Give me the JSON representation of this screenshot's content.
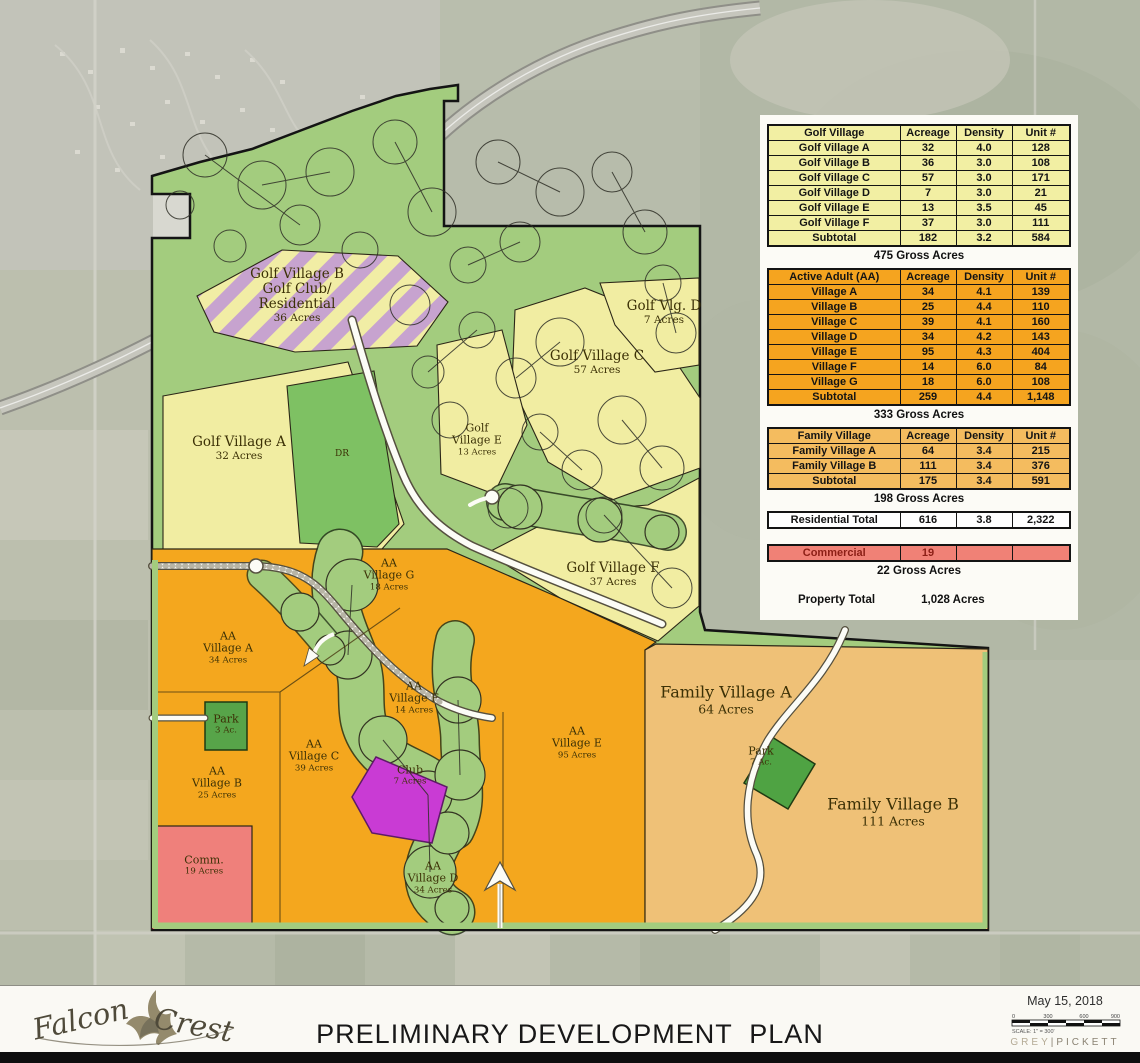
{
  "colors": {
    "golf_green": "#a3cc7e",
    "village_yellow": "#f1eda2",
    "active_adult_orange": "#f4a71e",
    "family_tan": "#efc177",
    "commercial_pink": "#ef807b",
    "club_magenta": "#c93bd4",
    "park_green": "#4fa343",
    "stripe_lavender": "#c7a3cf",
    "table_yellow": "#f2efa3",
    "table_orange": "#f5a41f",
    "table_tan": "#f4bc5f",
    "table_pink": "#f08176"
  },
  "map": {
    "labels": [
      {
        "id": "golf-village-b",
        "size": "md",
        "x": 297,
        "y": 296,
        "lines": [
          "Golf Village B",
          "Golf Club/",
          "Residential"
        ],
        "sub": "36 Acres"
      },
      {
        "id": "golf-vlg-d",
        "size": "md",
        "x": 664,
        "y": 313,
        "lines": [
          "Golf Vlg. D"
        ],
        "sub": "7 Acres"
      },
      {
        "id": "golf-village-c",
        "size": "md",
        "x": 597,
        "y": 363,
        "lines": [
          "Golf Village C"
        ],
        "sub": "57 Acres"
      },
      {
        "id": "golf-village-a",
        "size": "md",
        "x": 239,
        "y": 449,
        "lines": [
          "Golf Village A"
        ],
        "sub": "32 Acres"
      },
      {
        "id": "driving-range",
        "size": "xs",
        "x": 342,
        "y": 454,
        "lines": [
          "DR"
        ],
        "sub": ""
      },
      {
        "id": "golf-village-e",
        "size": "sm",
        "x": 477,
        "y": 440,
        "lines": [
          "Golf",
          "Village E"
        ],
        "sub": "13 Acres"
      },
      {
        "id": "golf-village-f",
        "size": "md",
        "x": 613,
        "y": 575,
        "lines": [
          "Golf Village F"
        ],
        "sub": "37 Acres"
      },
      {
        "id": "aa-village-g",
        "size": "sm",
        "x": 389,
        "y": 575,
        "lines": [
          "AA",
          "Village G"
        ],
        "sub": "18 Acres"
      },
      {
        "id": "aa-village-a",
        "size": "sm",
        "x": 228,
        "y": 648,
        "lines": [
          "AA",
          "Village A"
        ],
        "sub": "34 Acres"
      },
      {
        "id": "aa-village-f",
        "size": "sm",
        "x": 414,
        "y": 698,
        "lines": [
          "AA",
          "Village F"
        ],
        "sub": "14 Acres"
      },
      {
        "id": "park-3ac",
        "size": "sm",
        "x": 226,
        "y": 725,
        "lines": [
          "Park"
        ],
        "sub": "3 Ac."
      },
      {
        "id": "aa-village-c",
        "size": "sm",
        "x": 314,
        "y": 756,
        "lines": [
          "AA",
          "Village C"
        ],
        "sub": "39 Acres"
      },
      {
        "id": "aa-village-b",
        "size": "sm",
        "x": 217,
        "y": 783,
        "lines": [
          "AA",
          "Village B"
        ],
        "sub": "25 Acres"
      },
      {
        "id": "club",
        "size": "sm",
        "x": 410,
        "y": 776,
        "lines": [
          "Club"
        ],
        "sub": "7 Acres"
      },
      {
        "id": "aa-village-e",
        "size": "sm",
        "x": 577,
        "y": 743,
        "lines": [
          "AA",
          "Village E"
        ],
        "sub": "95 Acres"
      },
      {
        "id": "aa-village-d",
        "size": "sm",
        "x": 433,
        "y": 878,
        "lines": [
          "AA",
          "Village D"
        ],
        "sub": "34 Acres"
      },
      {
        "id": "commercial",
        "size": "sm",
        "x": 204,
        "y": 866,
        "lines": [
          "Comm."
        ],
        "sub": "19 Acres"
      },
      {
        "id": "family-village-a",
        "size": "lg",
        "x": 726,
        "y": 700,
        "lines": [
          "Family Village A"
        ],
        "sub": "64 Acres"
      },
      {
        "id": "park-7ac",
        "size": "sm",
        "x": 761,
        "y": 757,
        "lines": [
          "Park"
        ],
        "sub": "7 Ac."
      },
      {
        "id": "family-village-b",
        "size": "lg",
        "x": 893,
        "y": 812,
        "lines": [
          "Family Village B"
        ],
        "sub": "111 Acres"
      }
    ]
  },
  "summary": {
    "columns": [
      "Acreage",
      "Density",
      "Unit #"
    ],
    "sections": [
      {
        "kind": "table",
        "name": "golf-village-table",
        "theme": "golf",
        "title": "Golf Village",
        "rows": [
          [
            "Golf Village A",
            "32",
            "4.0",
            "128"
          ],
          [
            "Golf Village B",
            "36",
            "3.0",
            "108"
          ],
          [
            "Golf Village C",
            "57",
            "3.0",
            "171"
          ],
          [
            "Golf Village D",
            "7",
            "3.0",
            "21"
          ],
          [
            "Golf Village E",
            "13",
            "3.5",
            "45"
          ],
          [
            "Golf Village F",
            "37",
            "3.0",
            "111"
          ]
        ],
        "subtotal": [
          "Subtotal",
          "182",
          "3.2",
          "584"
        ],
        "gross": "475 Gross Acres"
      },
      {
        "kind": "table",
        "name": "active-adult-table",
        "theme": "aa",
        "title": "Active Adult (AA)",
        "rows": [
          [
            "Village A",
            "34",
            "4.1",
            "139"
          ],
          [
            "Village B",
            "25",
            "4.4",
            "110"
          ],
          [
            "Village C",
            "39",
            "4.1",
            "160"
          ],
          [
            "Village D",
            "34",
            "4.2",
            "143"
          ],
          [
            "Village E",
            "95",
            "4.3",
            "404"
          ],
          [
            "Village F",
            "14",
            "6.0",
            "84"
          ],
          [
            "Village G",
            "18",
            "6.0",
            "108"
          ]
        ],
        "subtotal": [
          "Subtotal",
          "259",
          "4.4",
          "1,148"
        ],
        "gross": "333 Gross Acres"
      },
      {
        "kind": "table",
        "name": "family-village-table",
        "theme": "family",
        "title": "Family Village",
        "rows": [
          [
            "Family Village A",
            "64",
            "3.4",
            "215"
          ],
          [
            "Family Village B",
            "111",
            "3.4",
            "376"
          ]
        ],
        "subtotal": [
          "Subtotal",
          "175",
          "3.4",
          "591"
        ],
        "gross": "198 Gross Acres"
      },
      {
        "kind": "total",
        "name": "residential-total-row",
        "theme": "white",
        "row": [
          "Residential Total",
          "616",
          "3.8",
          "2,322"
        ]
      },
      {
        "kind": "total",
        "name": "commercial-row",
        "theme": "commx",
        "row": [
          "Commercial",
          "19",
          "",
          ""
        ],
        "gross": "22 Gross Acres"
      },
      {
        "kind": "property",
        "name": "property-total",
        "label": "Property Total",
        "value": "1,028 Acres"
      }
    ]
  },
  "footer": {
    "logo_word1": "Falcon",
    "logo_word2": "Crest",
    "title": "PRELIMINARY DEVELOPMENT  PLAN",
    "date": "May 15, 2018",
    "scale_ticks": [
      "0",
      "300",
      "600",
      "900"
    ],
    "scale_caption": "SCALE: 1\" = 300'",
    "firm_left": "GREY",
    "firm_sep": "|",
    "firm_right": "PICKETT"
  }
}
